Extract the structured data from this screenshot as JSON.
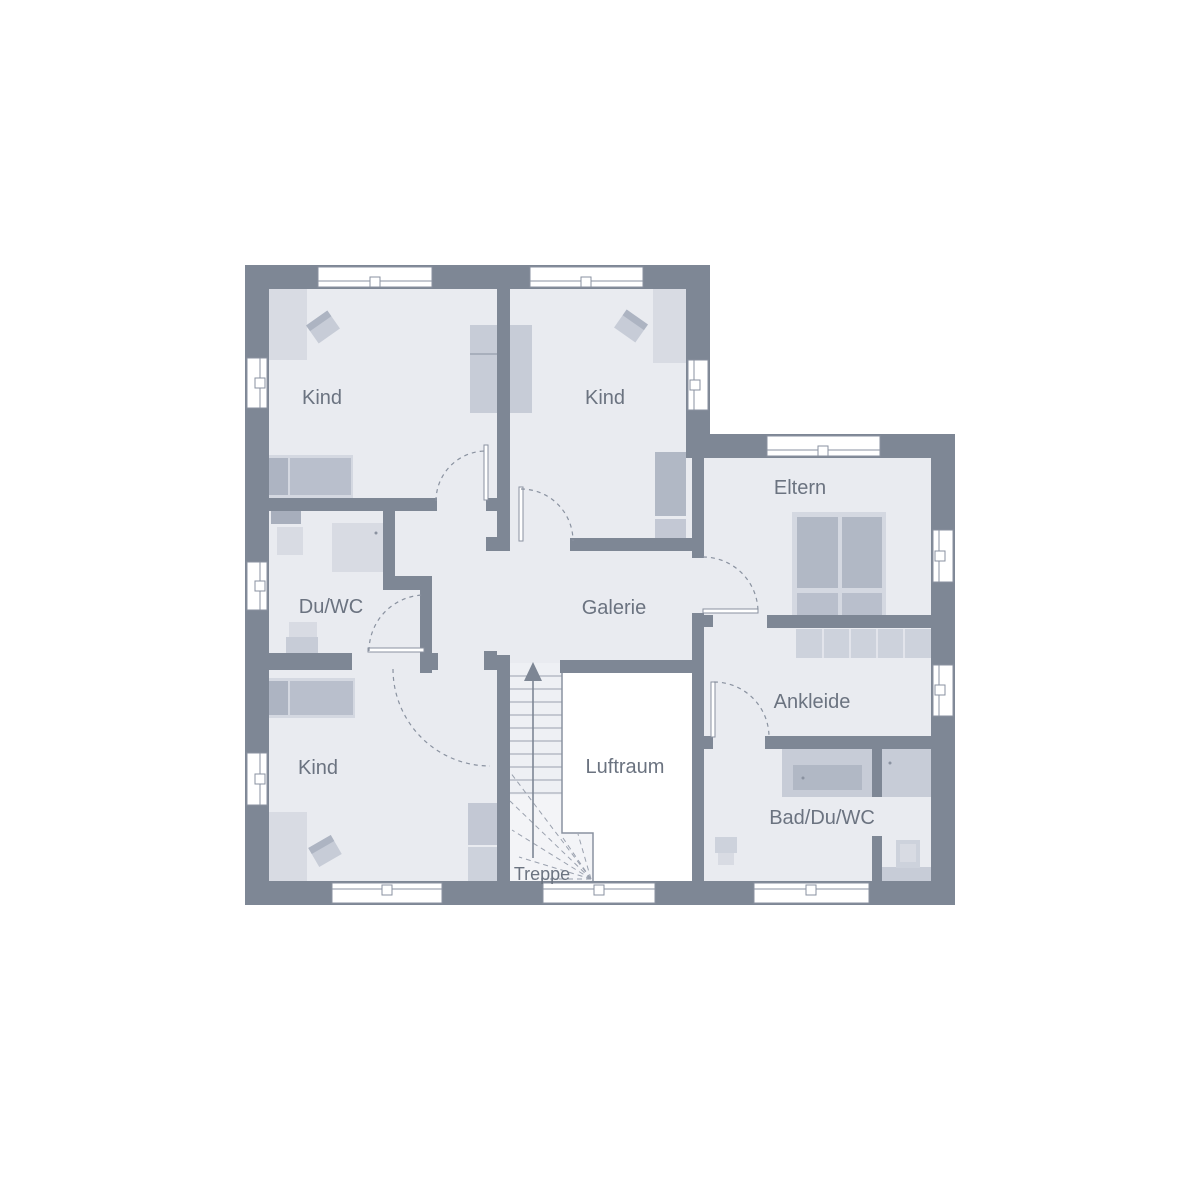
{
  "plan": {
    "floor_name": "floor-plan",
    "rooms": [
      {
        "id": "kind-top-left",
        "label": "Kind"
      },
      {
        "id": "kind-top-middle",
        "label": "Kind"
      },
      {
        "id": "eltern",
        "label": "Eltern"
      },
      {
        "id": "du-wc",
        "label": "Du/WC"
      },
      {
        "id": "galerie",
        "label": "Galerie"
      },
      {
        "id": "ankleide",
        "label": "Ankleide"
      },
      {
        "id": "kind-bottom-left",
        "label": "Kind"
      },
      {
        "id": "luftraum",
        "label": "Luftraum"
      },
      {
        "id": "bad-du-wc",
        "label": "Bad/Du/WC"
      },
      {
        "id": "treppe",
        "label": "Treppe"
      }
    ],
    "palette": {
      "background": "#ffffff",
      "wall": "#7e8795",
      "floor": "#e9ebf0",
      "void": "#ffffff",
      "furniture_light": "#d8dbe3",
      "furniture_mid": "#c7ccd7",
      "furniture_dark": "#b1b8c5",
      "line": "#8a92a0",
      "label_text": "#6b7380"
    }
  }
}
